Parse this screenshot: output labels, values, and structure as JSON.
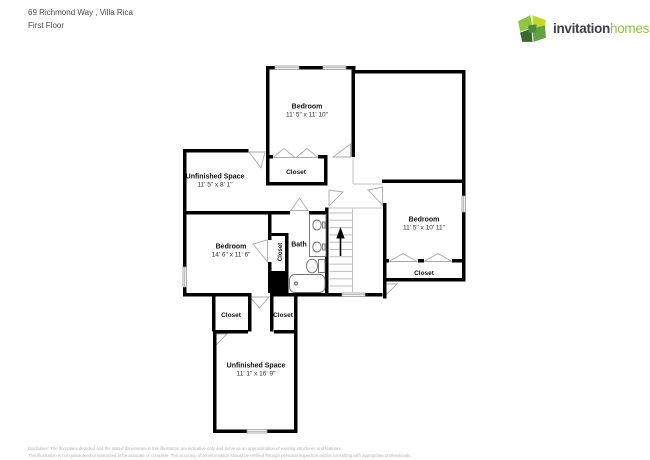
{
  "header": {
    "address": "69 Richmond Way , Villa Rica",
    "floor": "First Floor"
  },
  "logo": {
    "word1": "invitation",
    "word2": "homes",
    "icon": "invitation-homes-pinwheel-icon",
    "color_dark": "#3d4045",
    "color_green": "#8dc63f"
  },
  "rooms": {
    "bedroom_top": {
      "name": "Bedroom",
      "dims": "11' 5\" x 11' 10\""
    },
    "unfinished_top": {
      "name": "Unfinished Space",
      "dims": "11' 5\" x 8' 1\""
    },
    "closet_mid": {
      "name": "Closet"
    },
    "bedroom_right": {
      "name": "Bedroom",
      "dims": "11' 5\" x 10' 11\""
    },
    "closet_right": {
      "name": "Closet"
    },
    "bedroom_left": {
      "name": "Bedroom",
      "dims": "14' 6\" x 11' 6\""
    },
    "bath": {
      "name": "Bath"
    },
    "closet_bath": {
      "name": "Closet"
    },
    "closet_bottom_left": {
      "name": "Closet"
    },
    "closet_bottom_right": {
      "name": "Closet"
    },
    "unfinished_bottom": {
      "name": "Unfinished Space",
      "dims": "11' 1\" x 16' 9\""
    }
  },
  "plan_colors": {
    "wall": "#000000",
    "door": "#ababab",
    "fixture": "#6e6e6e"
  },
  "disclaimer": {
    "line1": "Disclaimer: The floorplans depicted and the stated dimensions in this illustration are indicative only and serve as an approximation of existing structures and features.",
    "line2": "This illustration is not guaranteed or warranted to be accurate or complete. The accuracy of all information should be verified through personal inspection and/or consulting with appropriate professionals."
  }
}
